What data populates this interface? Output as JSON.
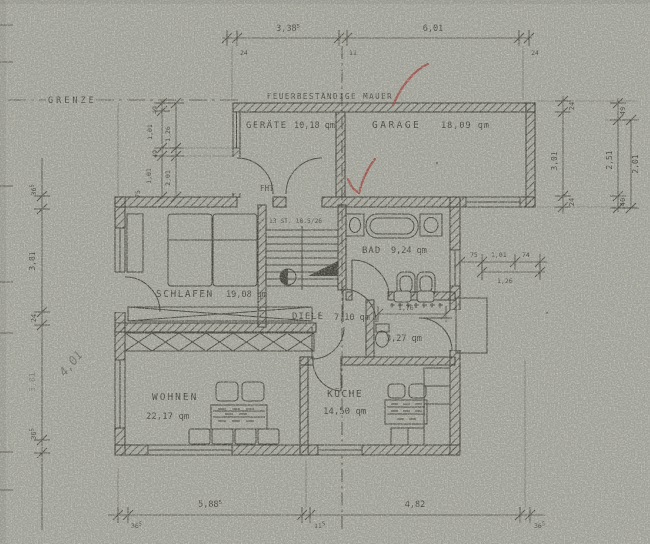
{
  "plan": {
    "labels": {
      "grenze": "GRENZE",
      "firewall": "FEUERBESTÄNDIGE MAUER",
      "fht": "FHT",
      "stair": "13 ST. 18.5/26"
    },
    "rooms": {
      "geraete": {
        "name": "GERÄTE",
        "area": "10,18 qm"
      },
      "garage": {
        "name": "GARAGE",
        "area": "18,09 qm"
      },
      "bad": {
        "name": "BAD",
        "area": "9,24 qm"
      },
      "schlafen": {
        "name": "SCHLAFEN",
        "area": "19,08 qm"
      },
      "diele": {
        "name": "DIELE",
        "area": "7,10 qm"
      },
      "wc": {
        "area": "3,27 qm"
      },
      "wohnen": {
        "name": "WOHNEN",
        "area": "22,17 qm"
      },
      "kueche": {
        "name": "KÜCHE",
        "area": "14,50 qm"
      }
    },
    "dims": {
      "top": {
        "wall_left": "24",
        "span_left": "3,38",
        "span_left_sup": "5",
        "axis": "11",
        "span_right": "6,01",
        "wall_right": "24"
      },
      "bottom": {
        "wall_left": "36",
        "wall_left_sup": "5",
        "span_left": "5,88",
        "span_left_sup": "5",
        "axis": "11",
        "axis_sup": "5",
        "span_right": "4,82",
        "wall_right": "36",
        "wall_right_sup": "5"
      },
      "left": {
        "wall_top": "36",
        "wall_top_sup": "5",
        "span_upper": "3,81",
        "wall_mid": "24",
        "span_lower": "3,81",
        "wall_bottom": "36",
        "wall_bottom_sup": "5",
        "pencil_note": "4,01"
      },
      "right_inner": {
        "wall_top": "24",
        "span": "3,01",
        "wall_bottom": "24"
      },
      "right_outer": {
        "top": "49",
        "span_a": "2,51",
        "span_b": "2,01",
        "bottom": "40"
      },
      "window_right": {
        "a": "75",
        "b": "1,01",
        "c": "74",
        "total": "1,26"
      },
      "entry": {
        "a": "49",
        "b": "1,01",
        "ab": "1,26",
        "c": "49",
        "d": "1,01",
        "cd": "2,01",
        "e": "75"
      },
      "wc_width": "1,76"
    },
    "colors": {
      "paper": "#a5a69c",
      "ink": "#35342c",
      "red_pen": "#9e3832",
      "pencil": "#7d8076"
    }
  }
}
